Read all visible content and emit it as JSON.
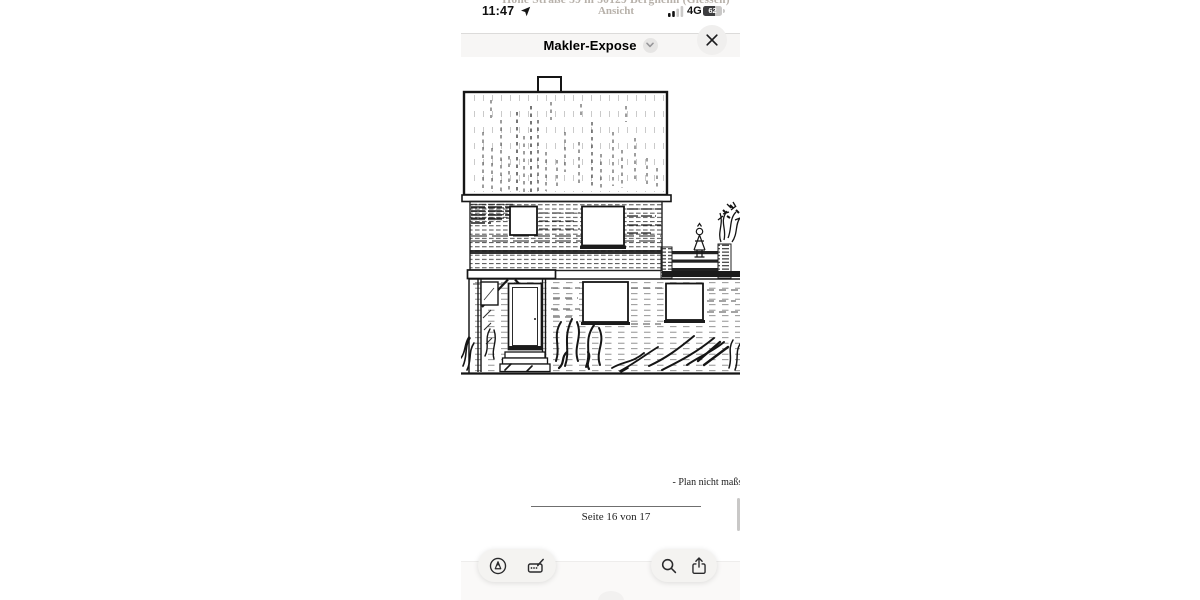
{
  "status_bar": {
    "time": "11:47",
    "network": "4G",
    "battery_percent": "62",
    "icons": [
      "location-arrow-icon",
      "signal-strength-icon",
      "battery-icon"
    ]
  },
  "nav_bar": {
    "title": "Makler-Expose",
    "icons": [
      "chevron-down-icon",
      "close-icon"
    ]
  },
  "document": {
    "heading_line1": "Hohe Straße 59 in 50129 Bergheim (Glessen)",
    "heading_line2": "Ansicht",
    "drawing": "black-and-white scanned line drawing of a house front elevation with roof, chimney, windows, entrance porch, balcony with plants and shrubbery",
    "footnote": "- Plan nicht maßst",
    "page_indicator": "Seite 16 von 17"
  },
  "toolbar": {
    "left_icons": [
      "markup-pen-icon",
      "autofill-icon"
    ],
    "right_icons": [
      "search-icon",
      "share-icon"
    ]
  },
  "colors": {
    "pill_background": "#f4f3f1",
    "nav_background": "#f7f6f5",
    "faded_heading": "#b7b1aa",
    "ink": "#1a1a1a",
    "scrollbar": "#c9c8c7"
  }
}
